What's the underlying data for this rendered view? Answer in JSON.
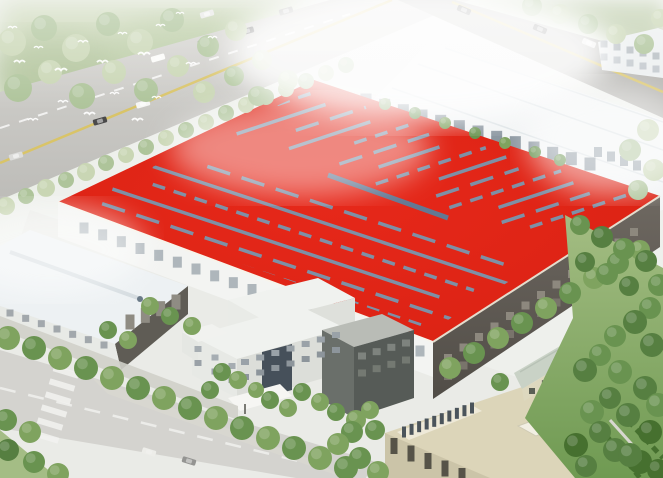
{
  "meta": {
    "alt": "aerial rendering of factory campus with large red roof",
    "subject": "industrial plant bird's-eye architectural rendering"
  },
  "scene": {
    "colors": {
      "bg": "#eef0ec",
      "veg_haze": "#c9d6b4",
      "veg_haze2": "#b9c9a4",
      "road": "#c9c8c4",
      "road_b": "#b3b2ae",
      "road_bottom": "#c2c1bd",
      "lane_yellow": "#d9c468",
      "lane_white": "#ffffff",
      "ground": "#e6e6e1",
      "path": "#d8d7d0",
      "inner_road": "#d0d0c9",
      "hall_white": "#f2f4f5",
      "hall_line": "#dde3e6",
      "hall_shadow": "#c9d0d4",
      "tower_white": "#eceff0",
      "roof_red": "#e02414",
      "roof_red_deep": "#c41e0f",
      "roof_dash": "#7e90a6",
      "roof_ridge": "#5d7d9a",
      "eave_light": "#f7f3ea",
      "eave_dark": "#e4dccd",
      "facade_white": "#f3f4f2",
      "facade_dark": "#645f58",
      "lefthall_roof": "#edf1f3",
      "lefthall_ridge": "#d5dce0",
      "lefthall_end": "#5f5c55",
      "lefthall_wall": "#e8eae6",
      "office_white": "#f0f2ef",
      "office_glass": "#46505a",
      "office_dark": "#565b57",
      "canopy": "#f6f6f3",
      "beige_roof": "#dcd5b9",
      "beige_wall": "#cbc4a8",
      "beige_sky_base": "#eee9d8",
      "green_roof": "#c9d2c6",
      "green_wall": "#ddd8bf",
      "grass": "#9cb87a",
      "grass_dark": "#6f9a52",
      "hedge": "#46702f",
      "haze": "#ffffff"
    },
    "tree_palette": [
      "#c9d6b4",
      "#aec49a",
      "#7fa35f",
      "#699350",
      "#567f41",
      "#46702f"
    ],
    "roof": {
      "patterns": {
        "s": "none",
        "d1": "24 12",
        "d2": "13 9"
      },
      "north_c": [
        196,
        212,
        228,
        244,
        260,
        276,
        292,
        308,
        324,
        340,
        356,
        372,
        388,
        402
      ],
      "north_t0": [
        34,
        12,
        48,
        18,
        60,
        22,
        38,
        12,
        52,
        26,
        16,
        42,
        22,
        30
      ],
      "north_t1": [
        12,
        26,
        10,
        30,
        8,
        20,
        34,
        12,
        16,
        28,
        10,
        22,
        30,
        14
      ],
      "north_p": [
        "d2",
        "s",
        "d1",
        "s",
        "d2",
        "d1",
        "s",
        "d2",
        "s",
        "d1",
        "d2",
        "s",
        "d1",
        "d2"
      ],
      "south_c": [
        80,
        98,
        116,
        134,
        152,
        170,
        186
      ],
      "south_t0": [
        24,
        44,
        12,
        34,
        16,
        28,
        20
      ],
      "south_t1": [
        16,
        32,
        10,
        26,
        42,
        12,
        22
      ],
      "south_p": [
        "s",
        "d1",
        "s",
        "d2",
        "s",
        "d1",
        "d2"
      ]
    },
    "windows": [
      [
        "w-halls",
        366,
        100,
        590,
        164,
        13,
        11,
        13,
        "#8c97a1"
      ],
      [
        "w-halls",
        598,
        152,
        650,
        170,
        5,
        8,
        10,
        "#98a2ab"
      ],
      [
        "w-halls",
        604,
        44,
        656,
        56,
        5,
        7,
        7,
        "#b6bdc2"
      ],
      [
        "w-halls",
        604,
        57,
        656,
        69,
        5,
        7,
        7,
        "#c2c8cd"
      ],
      [
        "w-red",
        84,
        228,
        420,
        351,
        19,
        9,
        11,
        "#aeb6bb"
      ],
      [
        "w-red",
        448,
        358,
        634,
        232,
        13,
        8,
        8,
        "#8d887e"
      ],
      [
        "w-red",
        448,
        376,
        634,
        250,
        13,
        8,
        8,
        "#79746b"
      ],
      [
        "w-lefthall",
        130,
        322,
        176,
        302,
        4,
        9,
        15,
        "#8f8c83"
      ],
      [
        "w-lefthall",
        10,
        313,
        104,
        345,
        7,
        7,
        7,
        "#a2a8ac"
      ],
      [
        "w-office",
        198,
        349,
        232,
        366,
        3,
        7,
        6,
        "#a6adb2"
      ],
      [
        "w-office",
        198,
        363,
        232,
        380,
        3,
        7,
        6,
        "#9aa1a7"
      ],
      [
        "w-office",
        245,
        362,
        336,
        335,
        7,
        8,
        6,
        "#9aa2a8"
      ],
      [
        "w-office",
        245,
        377,
        336,
        350,
        7,
        8,
        6,
        "#8d959b"
      ],
      [
        "w-office",
        362,
        356,
        406,
        343,
        4,
        8,
        7,
        "#7e837e"
      ],
      [
        "w-office",
        362,
        373,
        406,
        360,
        4,
        8,
        7,
        "#747972"
      ],
      [
        "w-beige",
        404,
        432,
        472,
        408,
        10,
        4,
        11,
        "#4b545b"
      ],
      [
        "w-beige",
        394,
        446,
        462,
        476,
        5,
        7,
        16,
        "#565348"
      ],
      [
        "w-green",
        532,
        391,
        648,
        321,
        10,
        6,
        6,
        "#5a5f55"
      ]
    ],
    "cars": [
      [
        100,
        121,
        -16,
        "#4a4a4a"
      ],
      [
        143,
        104,
        -16,
        "#f6f6f4"
      ],
      [
        112,
        76,
        -16,
        "#5a5a5a"
      ],
      [
        158,
        58,
        -16,
        "#fbfbf9"
      ],
      [
        205,
        42,
        -16,
        "#3a3a3a"
      ],
      [
        247,
        31,
        -16,
        "#6e6e6e"
      ],
      [
        207,
        14,
        -16,
        "#e8e8e6"
      ],
      [
        286,
        11,
        -16,
        "#b5b5b2"
      ],
      [
        16,
        156,
        -16,
        "#dcdcda"
      ],
      [
        464,
        10,
        23,
        "#3c3c3c"
      ],
      [
        540,
        29,
        23,
        "#303030"
      ],
      [
        589,
        43,
        23,
        "#eaeae8"
      ],
      [
        612,
        55,
        23,
        "#4a4a4a"
      ],
      [
        149,
        452,
        17,
        "#f4f4f1"
      ],
      [
        189,
        461,
        17,
        "#424242"
      ]
    ],
    "crosswalk": {
      "x": 66,
      "y": 372,
      "dx": -4,
      "dy": 13,
      "count": 6,
      "len": 26,
      "thick": 6,
      "angle": 17
    },
    "birds": [
      [
        14,
        60,
        1.1
      ],
      [
        34,
        46,
        0.9
      ],
      [
        55,
        68,
        1.2
      ],
      [
        78,
        40,
        1.0
      ],
      [
        97,
        60,
        1.1
      ],
      [
        118,
        32,
        0.9
      ],
      [
        138,
        52,
        1.2
      ],
      [
        156,
        24,
        0.9
      ],
      [
        58,
        100,
        1.0
      ],
      [
        84,
        112,
        1.1
      ],
      [
        110,
        92,
        0.9
      ],
      [
        28,
        118,
        1.0
      ],
      [
        132,
        118,
        1.1
      ],
      [
        152,
        96,
        0.9
      ],
      [
        186,
        62,
        1.0
      ],
      [
        208,
        36,
        0.9
      ],
      [
        176,
        12,
        0.8
      ],
      [
        8,
        26,
        0.9
      ]
    ],
    "trees": [
      [
        6,
        206,
        9,
        0
      ],
      [
        26,
        196,
        8,
        1
      ],
      [
        46,
        188,
        9,
        0
      ],
      [
        66,
        180,
        8,
        1
      ],
      [
        86,
        172,
        9,
        0
      ],
      [
        106,
        163,
        8,
        1
      ],
      [
        126,
        155,
        8,
        0
      ],
      [
        146,
        147,
        8,
        1
      ],
      [
        166,
        138,
        8,
        0
      ],
      [
        186,
        130,
        8,
        1
      ],
      [
        206,
        122,
        8,
        0
      ],
      [
        226,
        113,
        8,
        1
      ],
      [
        246,
        105,
        8,
        0
      ],
      [
        266,
        97,
        8,
        1
      ],
      [
        286,
        89,
        8,
        0
      ],
      [
        306,
        81,
        8,
        1
      ],
      [
        326,
        73,
        8,
        0
      ],
      [
        346,
        65,
        8,
        1
      ],
      [
        12,
        42,
        14,
        0
      ],
      [
        44,
        28,
        13,
        1
      ],
      [
        76,
        48,
        14,
        0
      ],
      [
        108,
        24,
        12,
        1
      ],
      [
        140,
        42,
        13,
        0
      ],
      [
        172,
        20,
        12,
        1
      ],
      [
        18,
        88,
        14,
        1
      ],
      [
        50,
        72,
        12,
        0
      ],
      [
        82,
        96,
        13,
        1
      ],
      [
        114,
        72,
        12,
        0
      ],
      [
        146,
        90,
        12,
        1
      ],
      [
        178,
        66,
        11,
        0
      ],
      [
        208,
        46,
        11,
        1
      ],
      [
        236,
        30,
        11,
        0
      ],
      [
        204,
        92,
        11,
        0
      ],
      [
        234,
        76,
        10,
        1
      ],
      [
        262,
        60,
        10,
        0
      ],
      [
        258,
        96,
        10,
        1
      ],
      [
        288,
        80,
        10,
        0
      ],
      [
        532,
        6,
        10,
        1
      ],
      [
        560,
        14,
        10,
        0
      ],
      [
        588,
        24,
        10,
        1
      ],
      [
        616,
        34,
        10,
        0
      ],
      [
        644,
        44,
        10,
        1
      ],
      [
        660,
        18,
        9,
        0
      ],
      [
        648,
        130,
        11,
        0
      ],
      [
        630,
        150,
        11,
        1
      ],
      [
        654,
        170,
        11,
        0
      ],
      [
        638,
        190,
        10,
        1
      ],
      [
        385,
        104,
        6,
        2
      ],
      [
        415,
        113,
        6,
        3
      ],
      [
        445,
        123,
        6,
        2
      ],
      [
        475,
        133,
        6,
        3
      ],
      [
        505,
        143,
        6,
        2
      ],
      [
        535,
        152,
        6,
        3
      ],
      [
        560,
        160,
        6,
        3
      ],
      [
        450,
        368,
        11,
        2
      ],
      [
        474,
        353,
        11,
        3
      ],
      [
        498,
        338,
        11,
        2
      ],
      [
        522,
        323,
        11,
        3
      ],
      [
        546,
        308,
        11,
        2
      ],
      [
        570,
        293,
        11,
        3
      ],
      [
        594,
        278,
        11,
        2
      ],
      [
        618,
        263,
        11,
        3
      ],
      [
        640,
        250,
        10,
        2
      ],
      [
        580,
        225,
        10,
        3
      ],
      [
        602,
        237,
        11,
        4
      ],
      [
        624,
        249,
        11,
        3
      ],
      [
        646,
        261,
        11,
        4
      ],
      [
        659,
        285,
        11,
        3
      ],
      [
        585,
        262,
        10,
        4
      ],
      [
        607,
        274,
        11,
        3
      ],
      [
        629,
        286,
        10,
        4
      ],
      [
        650,
        308,
        11,
        3
      ],
      [
        635,
        322,
        12,
        4
      ],
      [
        615,
        336,
        11,
        3
      ],
      [
        652,
        345,
        12,
        4
      ],
      [
        600,
        355,
        11,
        3
      ],
      [
        585,
        370,
        12,
        4
      ],
      [
        620,
        372,
        12,
        3
      ],
      [
        645,
        388,
        12,
        4
      ],
      [
        658,
        405,
        12,
        3
      ],
      [
        610,
        398,
        11,
        4
      ],
      [
        592,
        412,
        12,
        3
      ],
      [
        628,
        415,
        12,
        4
      ],
      [
        650,
        432,
        12,
        5
      ],
      [
        600,
        432,
        11,
        4
      ],
      [
        576,
        445,
        12,
        5
      ],
      [
        615,
        450,
        12,
        4
      ],
      [
        640,
        462,
        12,
        5
      ],
      [
        586,
        466,
        11,
        4
      ],
      [
        658,
        470,
        11,
        5
      ],
      [
        8,
        338,
        12,
        2
      ],
      [
        34,
        348,
        12,
        3
      ],
      [
        60,
        358,
        12,
        2
      ],
      [
        86,
        368,
        12,
        3
      ],
      [
        112,
        378,
        12,
        2
      ],
      [
        138,
        388,
        12,
        3
      ],
      [
        164,
        398,
        12,
        2
      ],
      [
        190,
        408,
        12,
        3
      ],
      [
        216,
        418,
        12,
        2
      ],
      [
        242,
        428,
        12,
        3
      ],
      [
        268,
        438,
        12,
        2
      ],
      [
        294,
        448,
        12,
        3
      ],
      [
        320,
        458,
        12,
        2
      ],
      [
        346,
        468,
        12,
        3
      ],
      [
        6,
        420,
        11,
        3
      ],
      [
        30,
        432,
        11,
        2
      ],
      [
        8,
        450,
        11,
        4
      ],
      [
        34,
        462,
        11,
        3
      ],
      [
        58,
        474,
        11,
        2
      ],
      [
        150,
        306,
        9,
        2
      ],
      [
        170,
        316,
        9,
        3
      ],
      [
        192,
        326,
        9,
        2
      ],
      [
        108,
        330,
        9,
        3
      ],
      [
        128,
        340,
        9,
        2
      ],
      [
        222,
        372,
        9,
        3
      ],
      [
        238,
        380,
        9,
        2
      ],
      [
        210,
        390,
        9,
        3
      ],
      [
        256,
        390,
        8,
        2
      ],
      [
        270,
        400,
        9,
        3
      ],
      [
        288,
        408,
        9,
        2
      ],
      [
        302,
        392,
        9,
        3
      ],
      [
        320,
        402,
        9,
        2
      ],
      [
        336,
        412,
        9,
        3
      ],
      [
        356,
        420,
        10,
        2
      ],
      [
        375,
        430,
        10,
        3
      ],
      [
        352,
        432,
        11,
        3
      ],
      [
        338,
        444,
        11,
        2
      ],
      [
        360,
        458,
        11,
        3
      ],
      [
        378,
        472,
        11,
        2
      ],
      [
        500,
        382,
        9,
        3
      ],
      [
        370,
        410,
        9,
        2
      ],
      [
        630,
        455,
        12,
        4
      ]
    ]
  }
}
